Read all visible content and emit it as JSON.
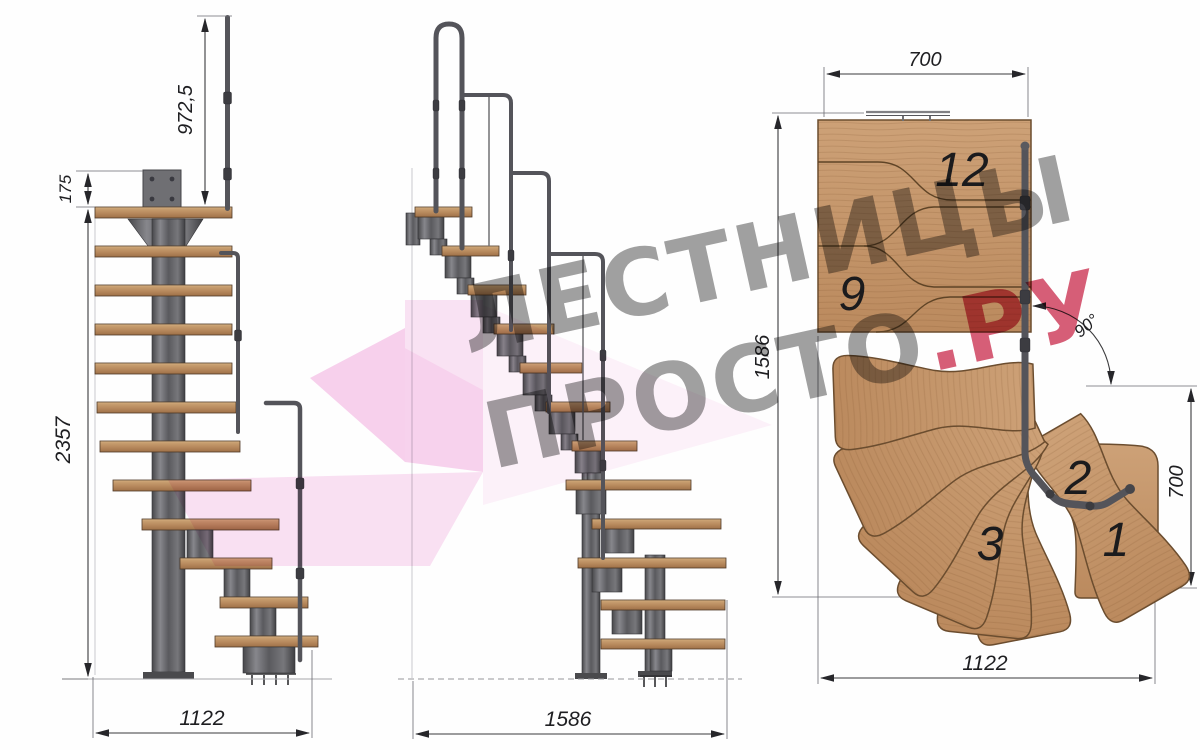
{
  "watermark": {
    "line1": "ЛЕСТНИЦЫ",
    "line2": "ПРОСТО",
    "line2_accent": ".РУ"
  },
  "front": {
    "total_height": "2357",
    "handrail_height": "972,5",
    "top_offset": "175",
    "width": "1122"
  },
  "side": {
    "width": "1586"
  },
  "plan": {
    "top_width": "700",
    "depth": "1586",
    "angle": "90°",
    "right_depth": "700",
    "bottom_width": "1122",
    "step12": "12",
    "step9": "9",
    "step3": "3",
    "step2": "2",
    "step1": "1"
  },
  "colors": {
    "wood_plan": "#c59a6c",
    "wood_side": "#b4835a",
    "metal": "#58585c",
    "dimension_line": "#3a3a3c",
    "watermark_gray": "#9b9b9b",
    "watermark_red": "#d34b66",
    "watermark_pink": "#f2b0de"
  }
}
